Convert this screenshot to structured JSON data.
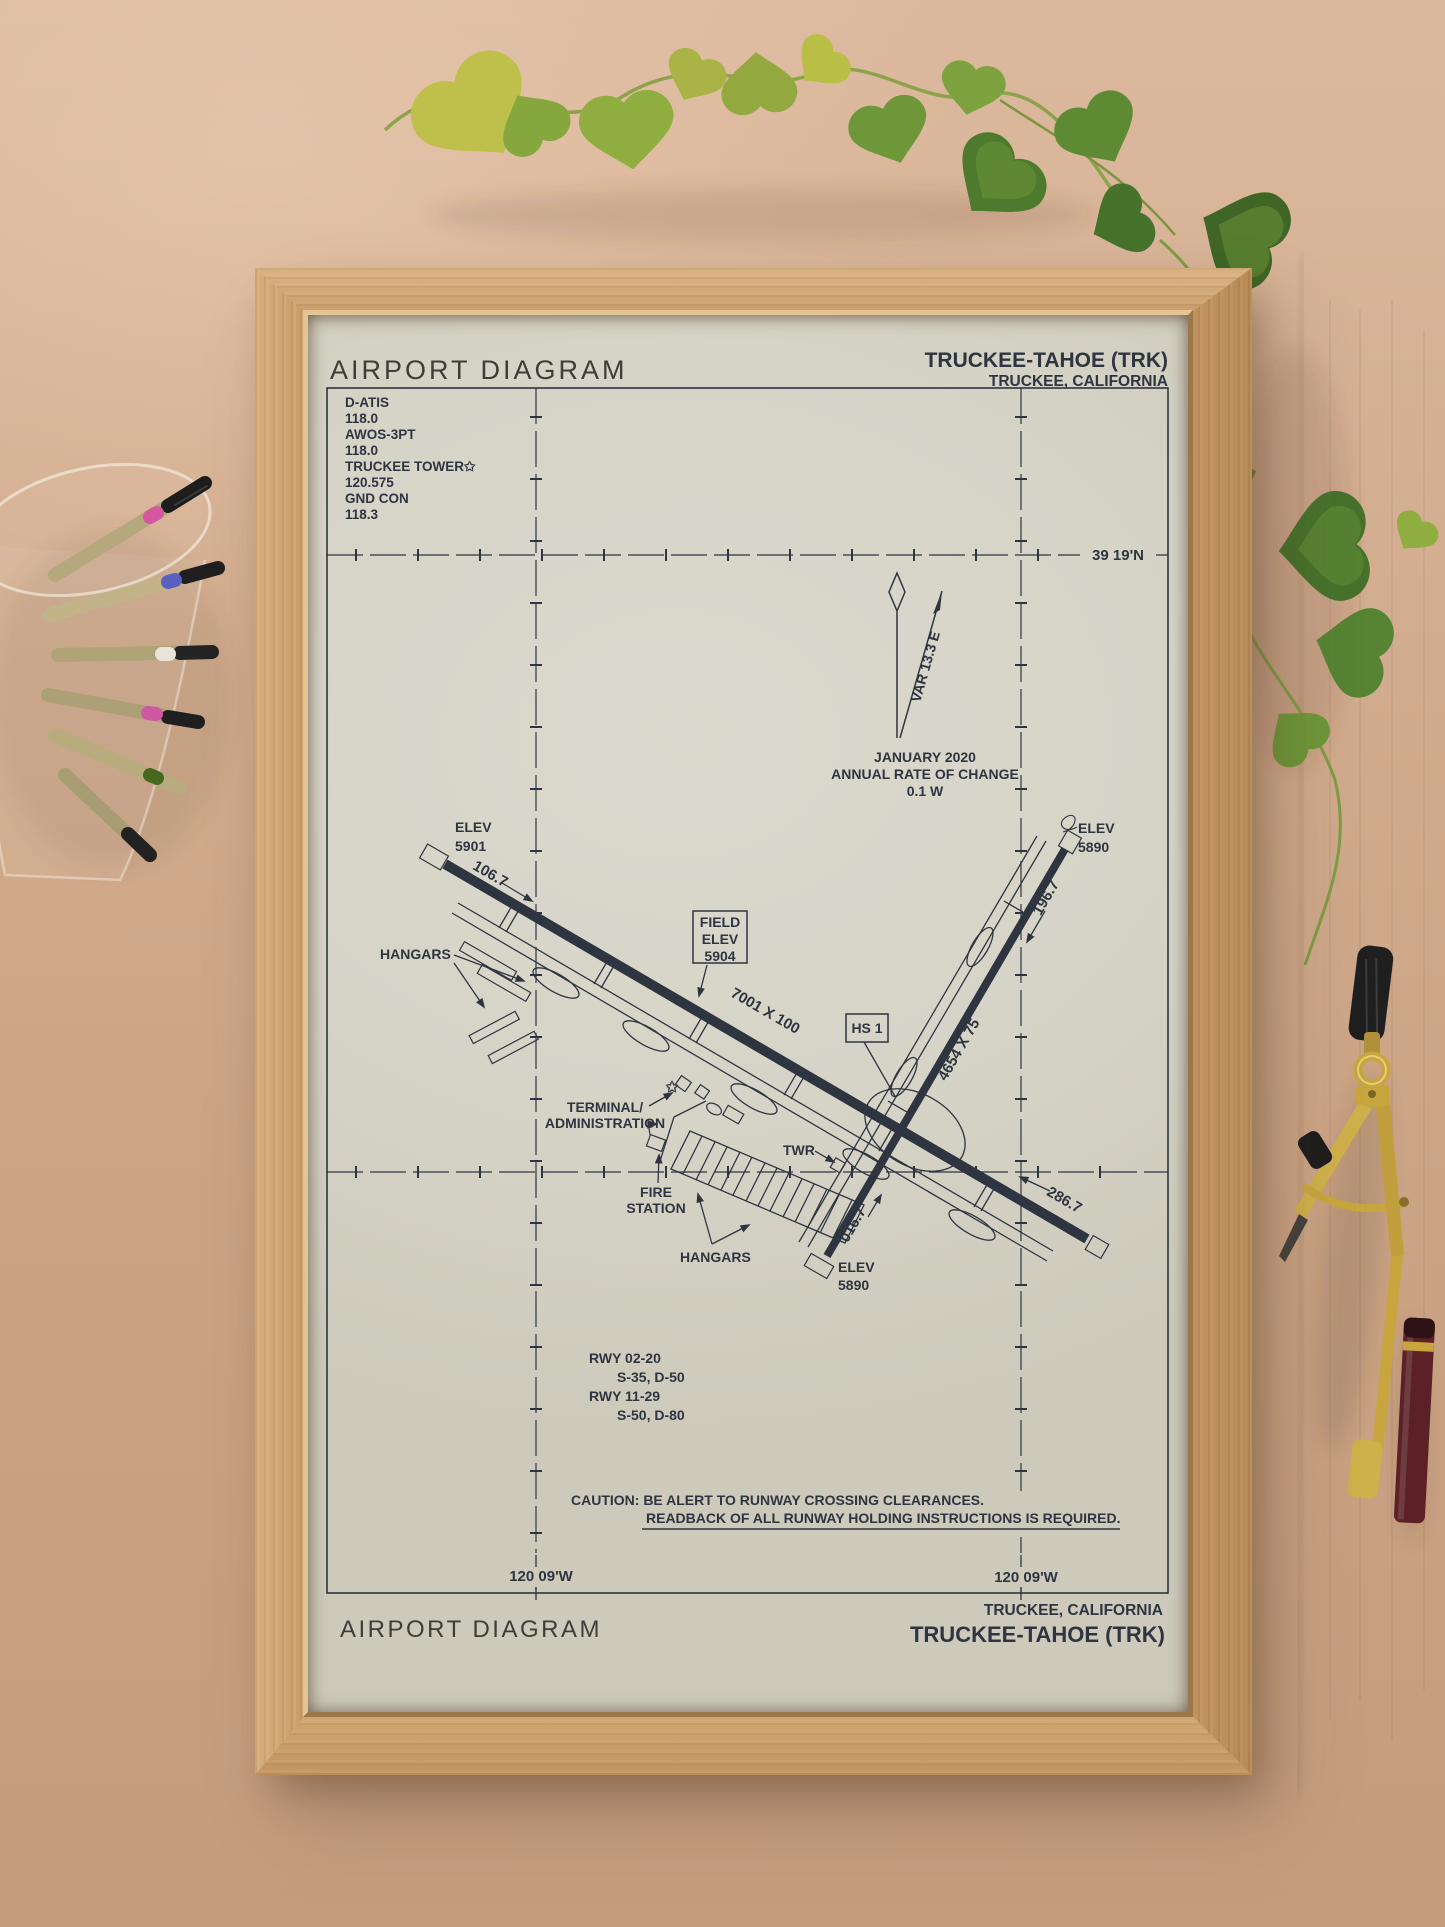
{
  "poster": {
    "header": {
      "title": "AIRPORT DIAGRAM",
      "airport": "TRUCKEE-TAHOE (TRK)",
      "city": "TRUCKEE, CALIFORNIA"
    },
    "frequencies": [
      "D-ATIS",
      "118.0",
      "AWOS-3PT",
      "118.0",
      "TRUCKEE TOWER✩",
      "120.575",
      "GND CON",
      "118.3"
    ],
    "grid": {
      "lat": "39 19'N",
      "lon_left": "120 09'W",
      "lon_right": "120 09'W"
    },
    "magvar": {
      "var": "VAR 13.3 E",
      "date": "JANUARY 2020",
      "rate_label": "ANNUAL RATE OF CHANGE",
      "rate_value": "0.1 W"
    },
    "field_elev": {
      "l1": "FIELD",
      "l2": "ELEV",
      "l3": "5904"
    },
    "hotspot": "HS 1",
    "rwy1129": {
      "dim": "7001 X 100",
      "hdg_w": "106.7",
      "hdg_e": "286.7",
      "elev_w_l1": "ELEV",
      "elev_w_l2": "5901"
    },
    "rwy0220": {
      "dim": "4654 X 75",
      "hdg_n": "196.7",
      "hdg_s": "016.7",
      "elev_n_l1": "ELEV",
      "elev_n_l2": "5890",
      "elev_s_l1": "ELEV",
      "elev_s_l2": "5890"
    },
    "labels": {
      "hangars_nw": "HANGARS",
      "hangars_s": "HANGARS",
      "terminal_l1": "TERMINAL/",
      "terminal_l2": "ADMINISTRATION",
      "twr": "TWR",
      "fire_l1": "FIRE",
      "fire_l2": "STATION"
    },
    "rwy_table": [
      "RWY 02-20",
      "S-35, D-50",
      "RWY 11-29",
      "S-50, D-80"
    ],
    "caution_l1": "CAUTION: BE ALERT TO RUNWAY CROSSING CLEARANCES.",
    "caution_l2": "READBACK OF ALL RUNWAY HOLDING INSTRUCTIONS IS REQUIRED.",
    "footer": {
      "city": "TRUCKEE, CALIFORNIA",
      "airport": "TRUCKEE-TAHOE (TRK)",
      "title": "AIRPORT DIAGRAM"
    },
    "symbols": {
      "beacon": "✩"
    }
  },
  "colors": {
    "ink": "#2f3540",
    "paper": "#d6d4c7",
    "frame_wood": "#cda26e",
    "background": "#cfa887",
    "plant_green": "#6d9739",
    "brass": "#c8a63f"
  }
}
